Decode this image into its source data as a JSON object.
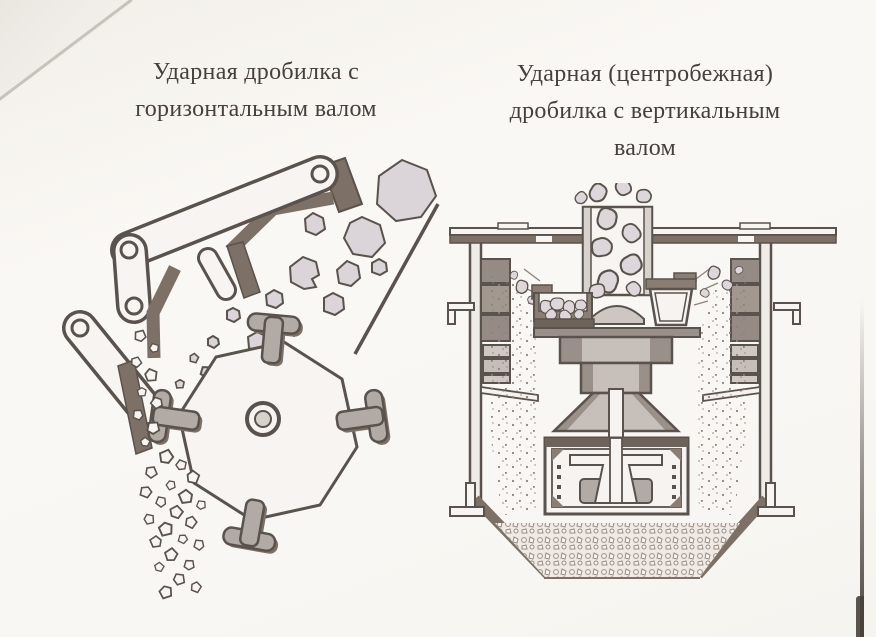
{
  "colors": {
    "paper": "#faf8f5",
    "ink": "#5a524c",
    "dark_fill": "#7d7066",
    "mid_gray": "#b2aaa5",
    "light_gray": "#cdc6c1",
    "rock_fill": "#dbd4d8",
    "speck": "#8f8178",
    "caption_text": "#45403b",
    "page_edge": "#3a332d"
  },
  "figures": [
    {
      "id": "impact-crusher-horizontal-shaft",
      "caption": "Ударная дробилка с горизонтальным валом",
      "caption_lines": [
        "Ударная дробилка с",
        "горизонтальным валом"
      ]
    },
    {
      "id": "impact-crusher-vertical-shaft",
      "caption": "Ударная (центробежная) дробилка с вертикальным валом",
      "caption_lines": [
        "Ударная (центробежная)",
        "дробилка с вертикальным",
        "валом"
      ]
    }
  ]
}
